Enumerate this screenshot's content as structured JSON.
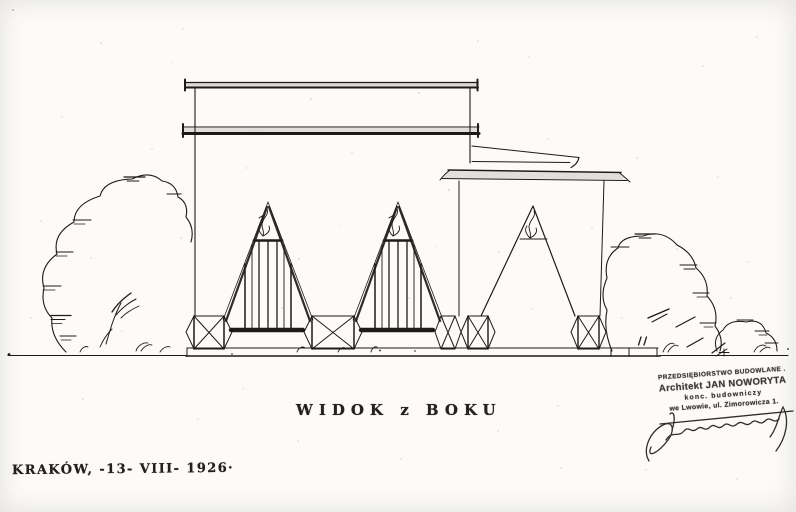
{
  "document": {
    "title": "WIDOK z BOKU",
    "location_date": "KRAKÓW, -13- VIII- 1926·"
  },
  "stamp": {
    "line1": "PRZEDSIĘBIORSTWO BUDOWLANE .",
    "line2": "Architekt JAN NOWORYTA",
    "line3": "konc. budowniczy",
    "line4": "we Lwowie, ul. Zimorowicza 1."
  },
  "colors": {
    "paper": "#fcfbf8",
    "ink": "#1c1b19",
    "stamp_ink": "#3d3b38"
  }
}
